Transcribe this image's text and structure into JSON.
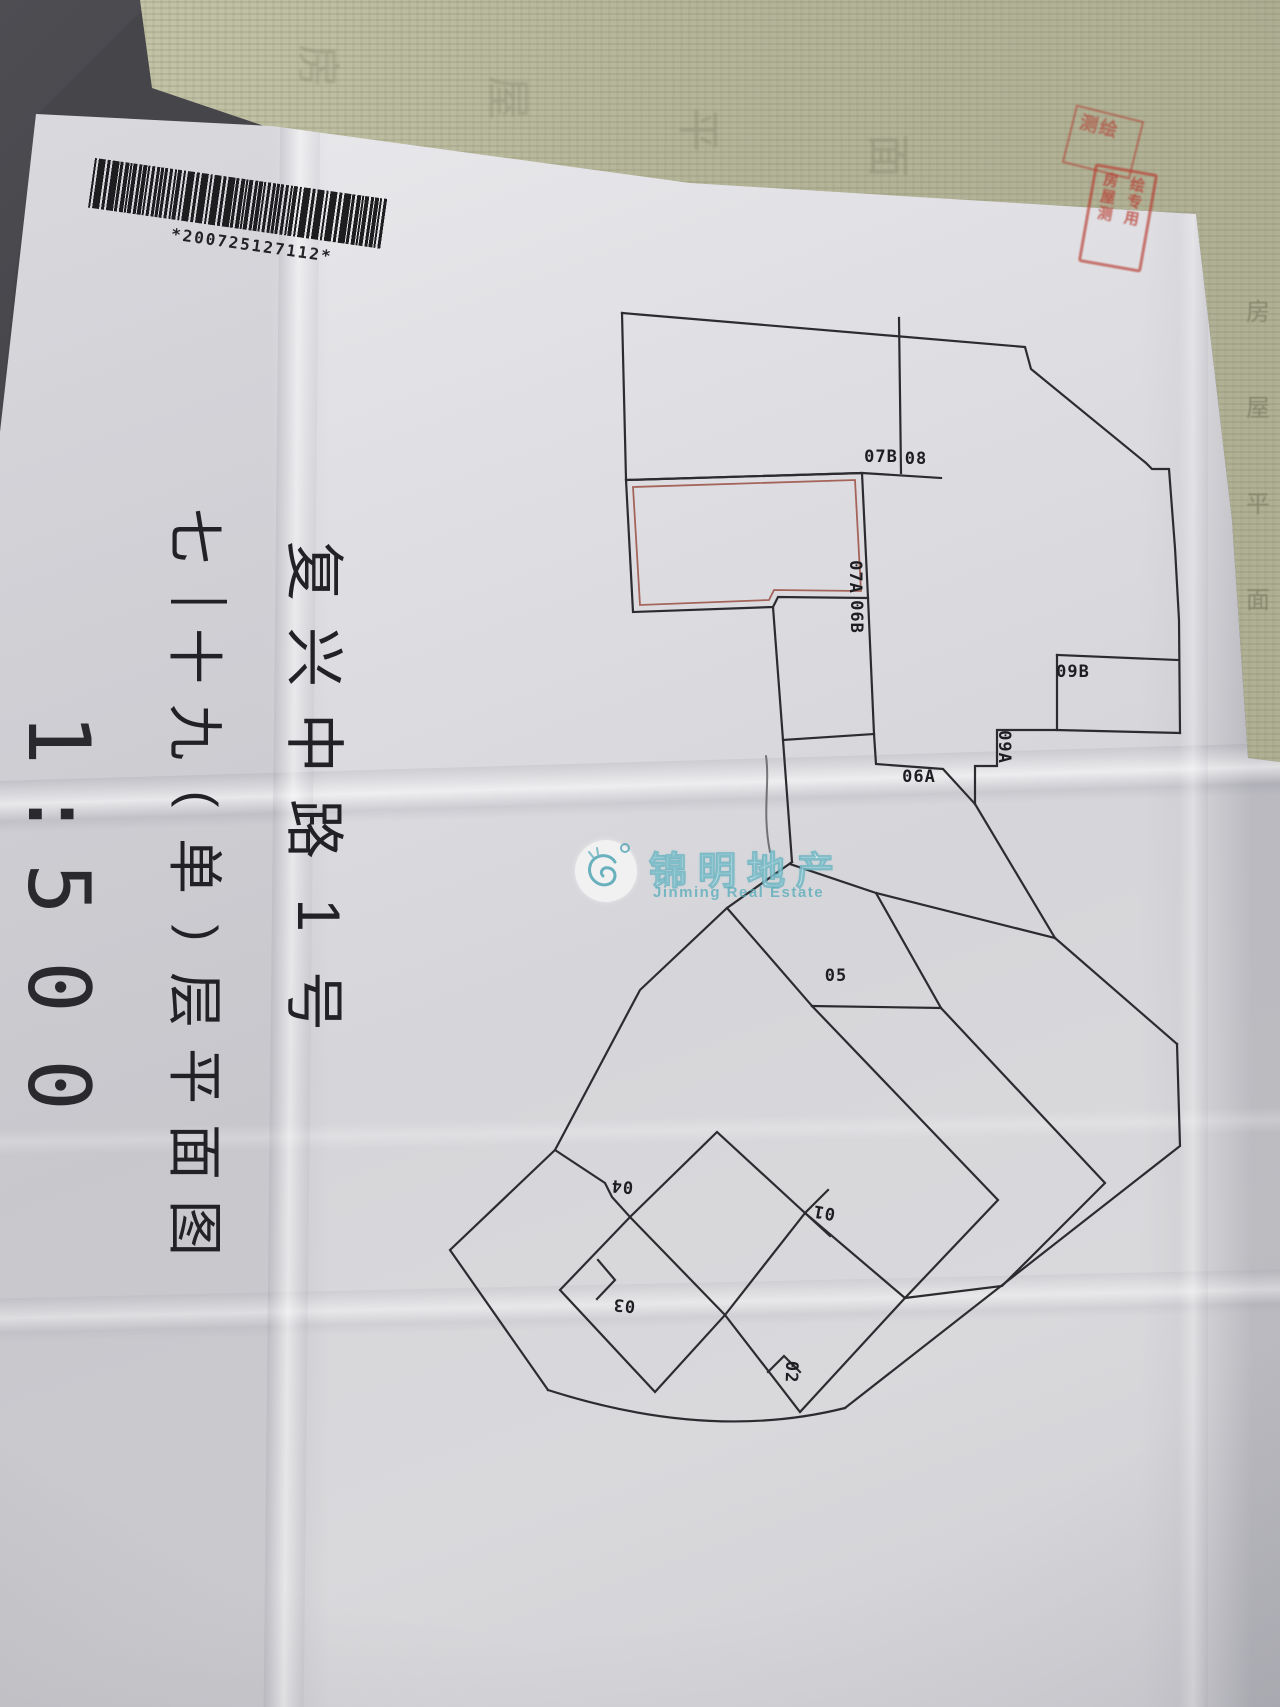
{
  "doc": {
    "barcode": "*200725127112*",
    "titles": {
      "street": "复兴中路1号",
      "street_chars": [
        "复",
        "兴",
        "中",
        "路",
        "1",
        "号"
      ],
      "floor_plan_title": "七—十九(单)层平面图",
      "floor_chars": [
        "七",
        "—",
        "十",
        "九",
        "(",
        "单",
        ")",
        "层",
        "平",
        "面",
        "图"
      ],
      "scale": "1:500",
      "scale_chars": [
        "1",
        ":",
        "5",
        "0",
        "0"
      ]
    },
    "plan": {
      "units": [
        {
          "label": "07B"
        },
        {
          "label": "08"
        },
        {
          "label": "07A"
        },
        {
          "label": "06B"
        },
        {
          "label": "09B"
        },
        {
          "label": "09A"
        },
        {
          "label": "06A"
        },
        {
          "label": "05"
        },
        {
          "label": "04"
        },
        {
          "label": "01"
        },
        {
          "label": "03"
        },
        {
          "label": "02"
        }
      ],
      "highlight_color": "#a5645a",
      "line_color": "#2c2c30"
    },
    "watermark": {
      "cn": "锦明地产",
      "en": "Jinming Real Estate"
    },
    "stamp": {
      "upper": "测绘",
      "col1": "房屋测",
      "col2": "绘专用"
    },
    "underlay": {
      "edge_chars": [
        "房",
        "屋",
        "平",
        "面"
      ],
      "band_chars": [
        "房",
        "屋",
        "平",
        "面"
      ]
    }
  }
}
